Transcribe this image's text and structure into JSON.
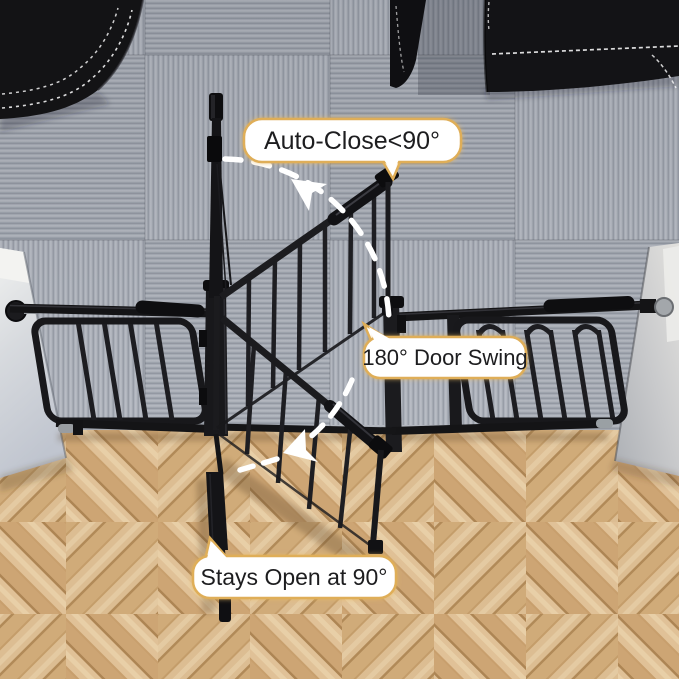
{
  "scene": {
    "type": "product-render",
    "subject": "auto-close safety gate installed between carpeted living room and herringbone wood hallway, top view",
    "annotations": {
      "auto_close": "Auto-Close<90°",
      "door_swing": "180° Door Swing",
      "stays_open": "Stays Open at 90°"
    },
    "colors": {
      "label_background": "#ffffff",
      "label_border": "#dfae58",
      "label_text": "#1d1d1f",
      "gate_metal": "#18181b",
      "swing_arrow": "#ffffff",
      "carpet": "#a7acb5",
      "wood_floor_light": "#dcbd92",
      "wood_floor_dark": "#c59a66",
      "wall": "#d6d8dc",
      "sofa_leather": "#131316",
      "sofa_stitching": "#ffffff"
    }
  }
}
